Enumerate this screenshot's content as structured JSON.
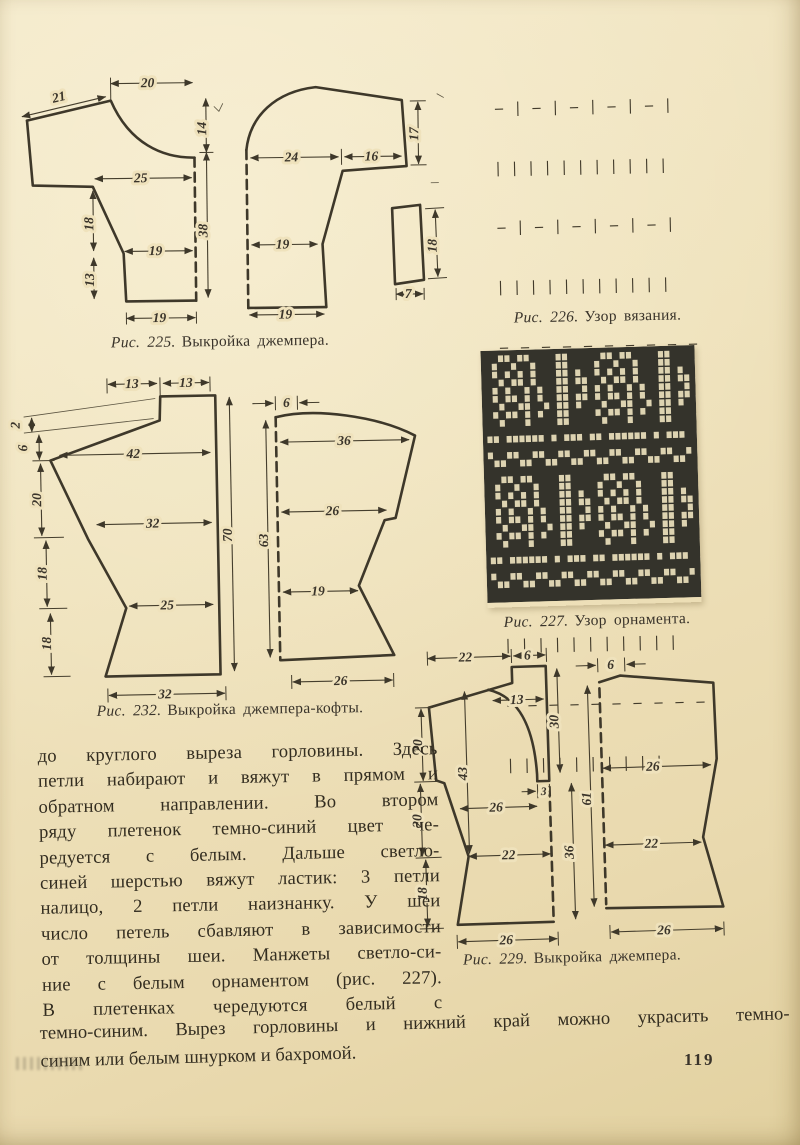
{
  "page": {
    "number": "119",
    "paper_color": "#efe2bc",
    "ink_color": "#3e382a"
  },
  "fig225": {
    "caption": {
      "label": "Рис. 225.",
      "text": "Выкройка джемпера."
    },
    "dims": [
      "21",
      "20",
      "14",
      "38",
      "25",
      "18",
      "19",
      "13",
      "19",
      "24",
      "16",
      "17",
      "19",
      "19",
      "18",
      "7"
    ]
  },
  "fig226": {
    "caption": {
      "label": "Рис. 226.",
      "text": "Узор вязания."
    },
    "rows": [
      "– | – | – | – | – |",
      "| | | | | | | | | | |",
      "– | – | – | – | – |",
      "| | | | | | | | | | |",
      "– – – – – – – – – –",
      "| | | | | | | | | | |",
      "– | – | – | – | – |",
      "| | | | | | | | | | |",
      "– | – | – | – | – |",
      "| | | | | | | | | | |",
      "– – – – – – – – – –",
      "| | | | | | | | | |"
    ]
  },
  "fig227": {
    "caption": {
      "label": "Рис. 227.",
      "text": "Узор орнамента."
    },
    "bg": "#34332b",
    "cell": "#ddd3b1",
    "grid": [
      "..XX.XX....XX.....XX.XX....XX...",
      ".X..X..X...XX....X..X..X...XX...",
      ".X.X.X.X...XX.X..X.X.X.X...XX.X.",
      "..X.XX.X...XX.XX..X.XX.X...XX.XX",
      ".X.X..X.X..XX..X.X.X..X.X..XX..X",
      ".X.XX.X.X..XX.XX.X.XX.X.X..XX.XX",
      "..X..XX..X.XX.X...X..XX..X.XX.X.",
      ".X.XX.X.X..XX....X.XX.X.X..XX...",
      "..X...X....XX.....X...X....XX...",
      "................................",
      "XX.XXXXXX.X.XXX.XX.XXXXXX.X.XXX.",
      "................................",
      "X..XX..XX..XX..XX..XX..XX..XX..X",
      ".XX..XX..XX..XX..XX..XX..XX..XX.",
      "................................",
      "..XX.XX....XX.....XX.XX....XX...",
      ".X..X..X...XX....X..X..X...XX...",
      ".X.X.X.X...XX.X..X.X.X.X...XX.X.",
      "..X.XX.X...XX.XX..X.XX.X...XX.XX",
      ".X.X..X.X..XX..X.X.X..X.X..XX..X",
      ".X.XX.X.X..XX.XX.X.XX.X.X..XX.XX",
      "..X..XX..X.XX.X...X..XX..X.XX.X.",
      ".X.XX.X.X..XX....X.XX.X.X..XX...",
      "..X...X....XX.....X...X....XX...",
      "................................",
      "XX.XXXXXX.X.XXX.XX.XXXXXX.X.XXX.",
      "................................",
      "X..XX..XX..XX..XX..XX..XX..XX..X",
      ".XX..XX..XX..XX..XX..XX..XX..XX.",
      "................................"
    ]
  },
  "fig232": {
    "caption": {
      "label": "Рис. 232.",
      "text": "Выкройка джемпера-кофты."
    },
    "dims": [
      "13",
      "13",
      "2",
      "6",
      "42",
      "20",
      "32",
      "18",
      "25",
      "18",
      "70",
      "32",
      "6",
      "36",
      "26",
      "19",
      "63",
      "26"
    ]
  },
  "fig229": {
    "caption": {
      "label": "Рис. 229.",
      "text": "Выкройка джемпера."
    },
    "dims": [
      "22",
      "6",
      "13",
      "30",
      "43",
      "3",
      "26",
      "22",
      "36",
      "20",
      "20",
      "18",
      "26",
      "6",
      "26",
      "22",
      "61",
      "26"
    ]
  },
  "body": {
    "lines": [
      "до круглого выреза горловины. Здесь",
      "петли набирают и вяжут в прямом и",
      "обратном направлении. Во втором",
      "ряду плетенок темно-синий цвет че-",
      "редуется с белым. Дальше светло-",
      "синей шерстью вяжут ластик: 3 петли",
      "налицо, 2 петли наизнанку. У шеи",
      "число петель сбавляют в зависимости",
      "от толщины шеи. Манжеты светло-си-",
      "ние с белым орнаментом (рис. 227).",
      "В плетенках чередуются белый с",
      "темно-синим. Вырез горловины и нижний край можно украсить темно-",
      "синим или белым шнурком и бахромой."
    ]
  }
}
